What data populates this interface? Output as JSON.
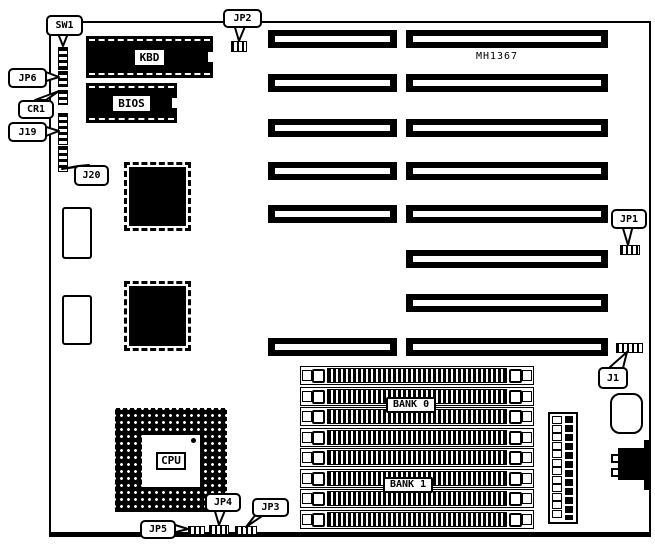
{
  "diagram": {
    "model_label": "MH1367",
    "chip_labels": {
      "kbd": "KBD",
      "bios": "BIOS",
      "cpu": "CPU"
    },
    "bank_labels": [
      "BANK 0",
      "BANK 1"
    ],
    "callouts": [
      {
        "id": "sw1",
        "label": "SW1",
        "box": [
          46,
          15,
          33,
          17
        ],
        "tail": "57,31 69,31 63,46"
      },
      {
        "id": "jp6",
        "label": "JP6",
        "box": [
          8,
          68,
          35,
          16
        ],
        "tail": "43,71 43,82 59,77"
      },
      {
        "id": "cr1",
        "label": "CR1",
        "box": [
          18,
          100,
          32,
          15
        ],
        "tail": "35,100 46,100 59,91"
      },
      {
        "id": "j19",
        "label": "J19",
        "box": [
          8,
          122,
          35,
          16
        ],
        "tail": "43,126 43,137 59,131"
      },
      {
        "id": "j20",
        "label": "J20",
        "box": [
          74,
          165,
          31,
          17
        ],
        "tail": "78,166 89,165 62,169"
      },
      {
        "id": "jp2",
        "label": "JP2",
        "box": [
          223,
          9,
          35,
          15
        ],
        "tail": "234,24 246,24 239,41"
      },
      {
        "id": "jp1",
        "label": "JP1",
        "box": [
          611,
          209,
          32,
          16
        ],
        "tail": "622,225 633,225 628,245"
      },
      {
        "id": "j1",
        "label": "J1",
        "box": [
          598,
          367,
          26,
          18
        ],
        "tail": "610,367 622,372 627,352"
      },
      {
        "id": "jp4",
        "label": "JP4",
        "box": [
          205,
          493,
          32,
          15
        ],
        "tail": "214,508 226,508 219,525"
      },
      {
        "id": "jp3",
        "label": "JP3",
        "box": [
          252,
          498,
          33,
          15
        ],
        "tail": "257,513 268,512 246,527"
      },
      {
        "id": "jp5",
        "label": "JP5",
        "box": [
          140,
          520,
          32,
          15
        ],
        "tail": "172,524 172,533 188,529"
      }
    ],
    "jumper_blocks": [
      {
        "id": "jp2",
        "rect": [
          231,
          41,
          14,
          9
        ]
      },
      {
        "id": "jp1",
        "rect": [
          620,
          245,
          18,
          8
        ]
      },
      {
        "id": "j1",
        "rect": [
          616,
          343,
          25,
          8
        ]
      },
      {
        "id": "jp5",
        "rect": [
          188,
          526,
          15,
          7
        ]
      },
      {
        "id": "jp4",
        "rect": [
          209,
          525,
          18,
          8
        ]
      },
      {
        "id": "jp3",
        "rect": [
          235,
          526,
          20,
          7
        ]
      }
    ],
    "side_components": [
      {
        "id": "sw1",
        "rect": [
          58,
          47,
          8,
          21
        ]
      },
      {
        "id": "jp6",
        "rect": [
          58,
          71,
          8,
          14
        ]
      },
      {
        "id": "cr1",
        "rect": [
          58,
          90,
          8,
          13
        ]
      },
      {
        "id": "j19",
        "rect": [
          58,
          113,
          8,
          30
        ]
      },
      {
        "id": "j20",
        "rect": [
          58,
          146,
          8,
          24
        ]
      }
    ],
    "isa_slots": {
      "left_x": 268,
      "left_w": 129,
      "right_x": 406,
      "right_w": 202,
      "height": 18,
      "rows": [
        {
          "y": 30,
          "left": true
        },
        {
          "y": 74,
          "left": true
        },
        {
          "y": 119,
          "left": true
        },
        {
          "y": 162,
          "left": true
        },
        {
          "y": 205,
          "left": true
        },
        {
          "y": 250,
          "left": false
        },
        {
          "y": 294,
          "left": false
        },
        {
          "y": 338,
          "left": true
        }
      ]
    },
    "simm_sockets": {
      "x": 300,
      "width": 232,
      "height": 17,
      "ys": [
        366,
        387,
        407,
        428,
        448,
        469,
        489,
        510
      ]
    },
    "power_connector": {
      "pin_count": 12
    }
  }
}
